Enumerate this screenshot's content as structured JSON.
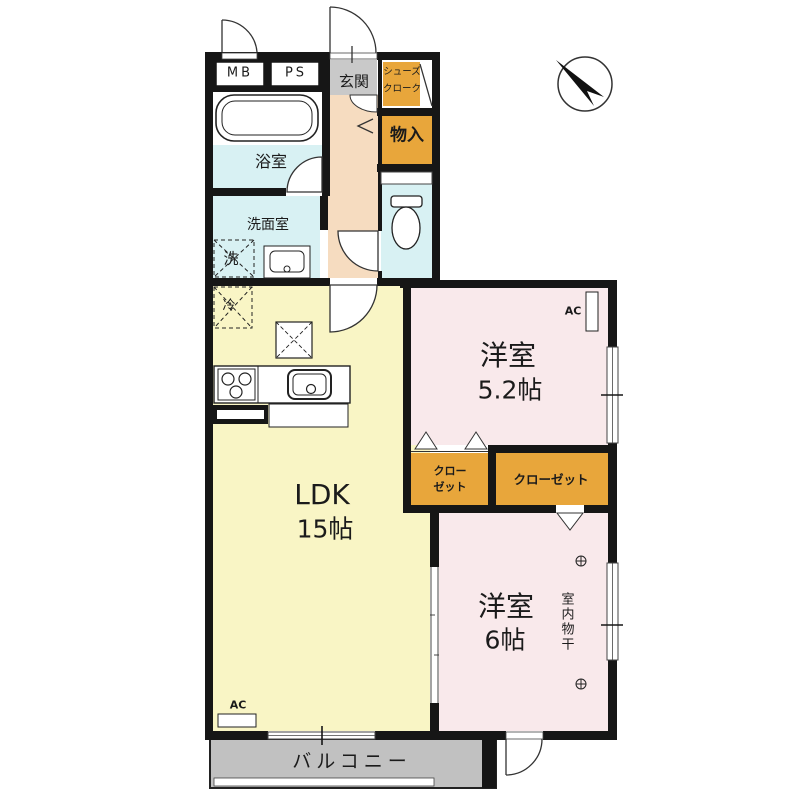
{
  "plan": {
    "type": "apartment-floor-plan",
    "labels": {
      "mb": "MB",
      "ps": "PS",
      "entrance": "玄関",
      "shoe_closet_line1": "シューズ",
      "shoe_closet_line2": "クローク",
      "storage": "物入",
      "bathroom": "浴室",
      "washroom": "洗面室",
      "washing_machine": "洗",
      "refrigerator": "冷",
      "ldk_name": "LDK",
      "ldk_size": "15帖",
      "bedroom_5_2_name": "洋室",
      "bedroom_5_2_size": "5.2帖",
      "closet_small_line1": "クロー",
      "closet_small_line2": "ゼット",
      "closet_large": "クローゼット",
      "bedroom_6_name": "洋室",
      "bedroom_6_size": "6帖",
      "indoor_drying": "室内物干",
      "ac_bedroom": "AC",
      "ac_ldk": "AC",
      "balcony": "バルコニー"
    },
    "colors": {
      "ldk_fill": "#F9F5C5",
      "bedroom_fill": "#F9E9EB",
      "hall_fill": "#F6DCC0",
      "wet_fill": "#D8F1F3",
      "closet_fill": "#E8A63B",
      "entry_gray": "#C9C9C9",
      "balcony_gray": "#C1C1C1",
      "wall": "#161616"
    }
  }
}
